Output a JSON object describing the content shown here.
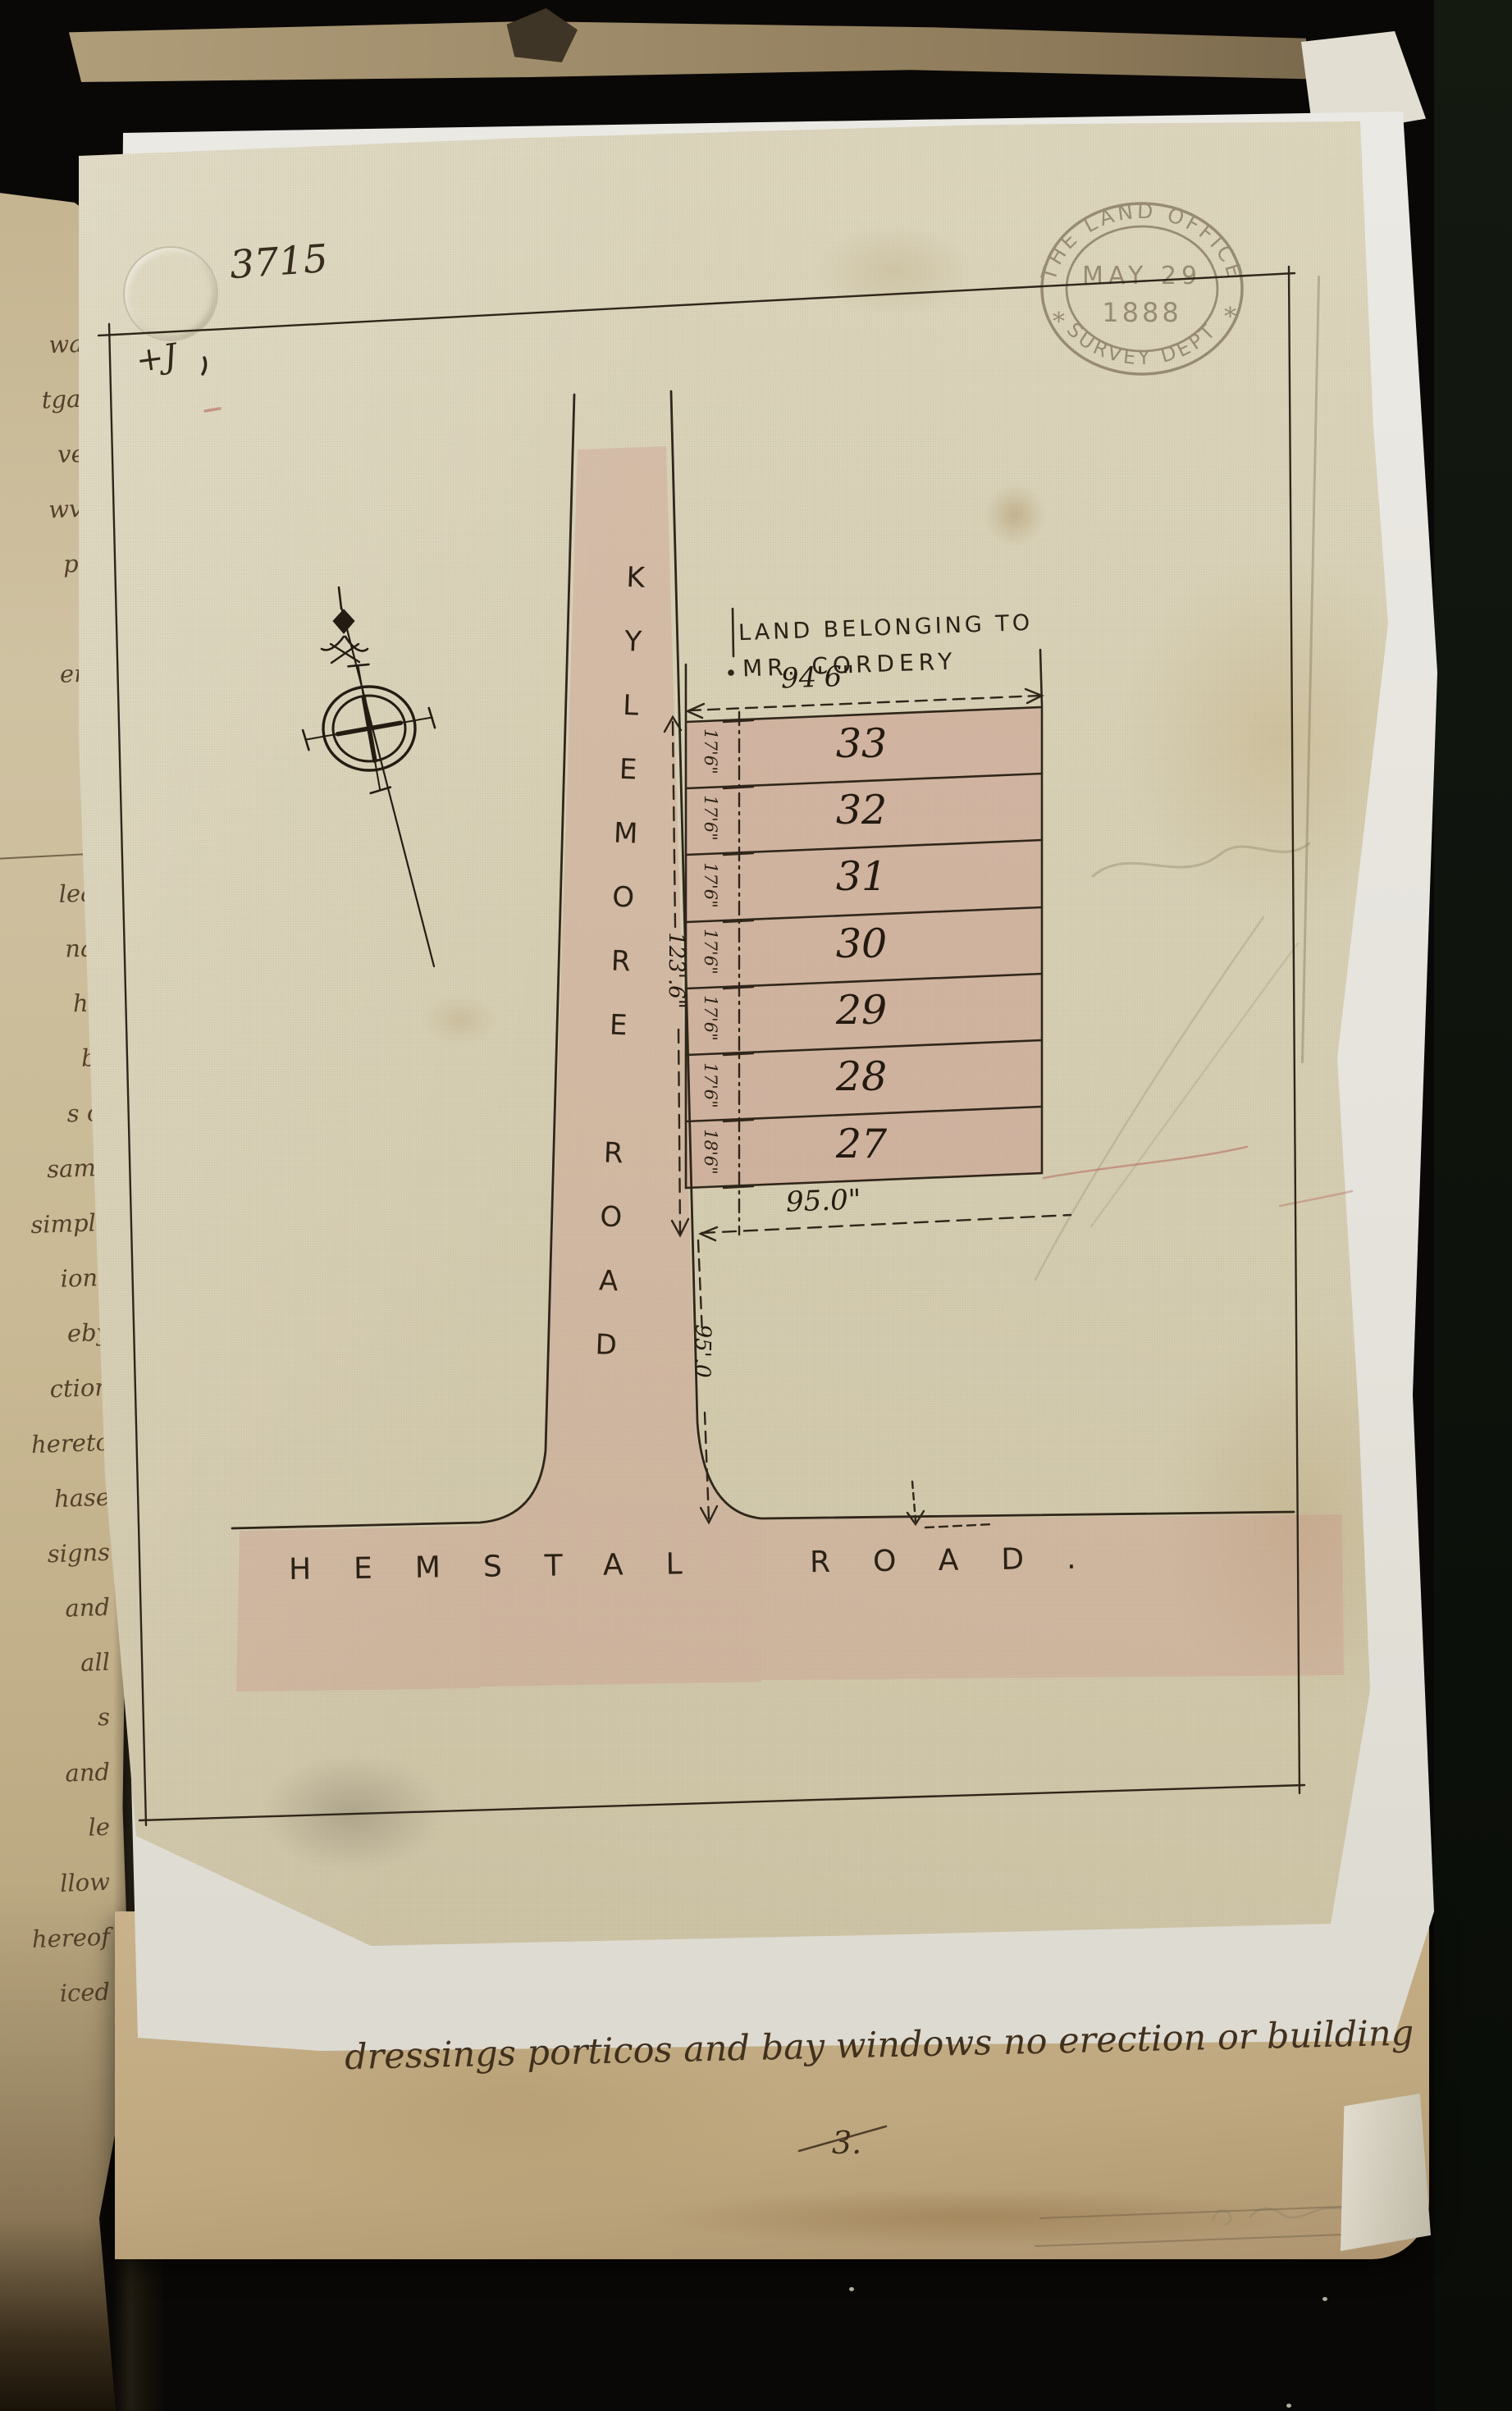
{
  "book": {
    "margin_fragments": [
      "in",
      "ward",
      "tgage",
      "very",
      "wvey",
      "plot",
      "ad",
      "emy",
      "le",
      "n",
      "of",
      "lean",
      "nan",
      "he,",
      "by",
      "s of",
      "same",
      "simple",
      "ions",
      "eby",
      "ction",
      "hereto",
      "hase",
      "signs",
      "and",
      "all",
      "s",
      "and",
      "le",
      "llow",
      "hereof",
      "iced"
    ]
  },
  "plan_sheet": {
    "reference_number": "3715",
    "corner_mark": "+J",
    "owner_label_line1": "LAND BELONGING TO",
    "owner_label_line2": "MR. CORDERY",
    "road_vertical": "KYLEMORE ROAD",
    "road_horizontal": "HEMSTAL ROAD.",
    "dimensions": {
      "top_width": "94'6\"",
      "bottom_width": "95.0\"",
      "left_total_depth": "123'.6\"",
      "road_frontage": "95'.0"
    },
    "plots": [
      {
        "number": "33",
        "depth": "17'6\""
      },
      {
        "number": "32",
        "depth": "17'6\""
      },
      {
        "number": "31",
        "depth": "17'6\""
      },
      {
        "number": "30",
        "depth": "17'6\""
      },
      {
        "number": "29",
        "depth": "17'6\""
      },
      {
        "number": "28",
        "depth": "17'6\""
      },
      {
        "number": "27",
        "depth": "18'6\""
      }
    ]
  },
  "stamp": {
    "top_arc": "THE LAND OFFICE",
    "date_line1": "MAY 29",
    "date_line2": "1888",
    "bottom_arc": "SURVEY DEPT",
    "star_left": "*",
    "star_right": "*"
  },
  "notes": {
    "annotation_line": "dressings porticos and bay windows no erection or building",
    "page_number": "3."
  },
  "colors": {
    "ink": "#2f261a",
    "pink_wash": "#c98f86",
    "stamp_ink": "#8a7c64",
    "cloth": "#d6cfb4",
    "backing_sheet": "#e9e7e1",
    "old_page": "#cfc2a2",
    "cover": "#0a0806"
  }
}
